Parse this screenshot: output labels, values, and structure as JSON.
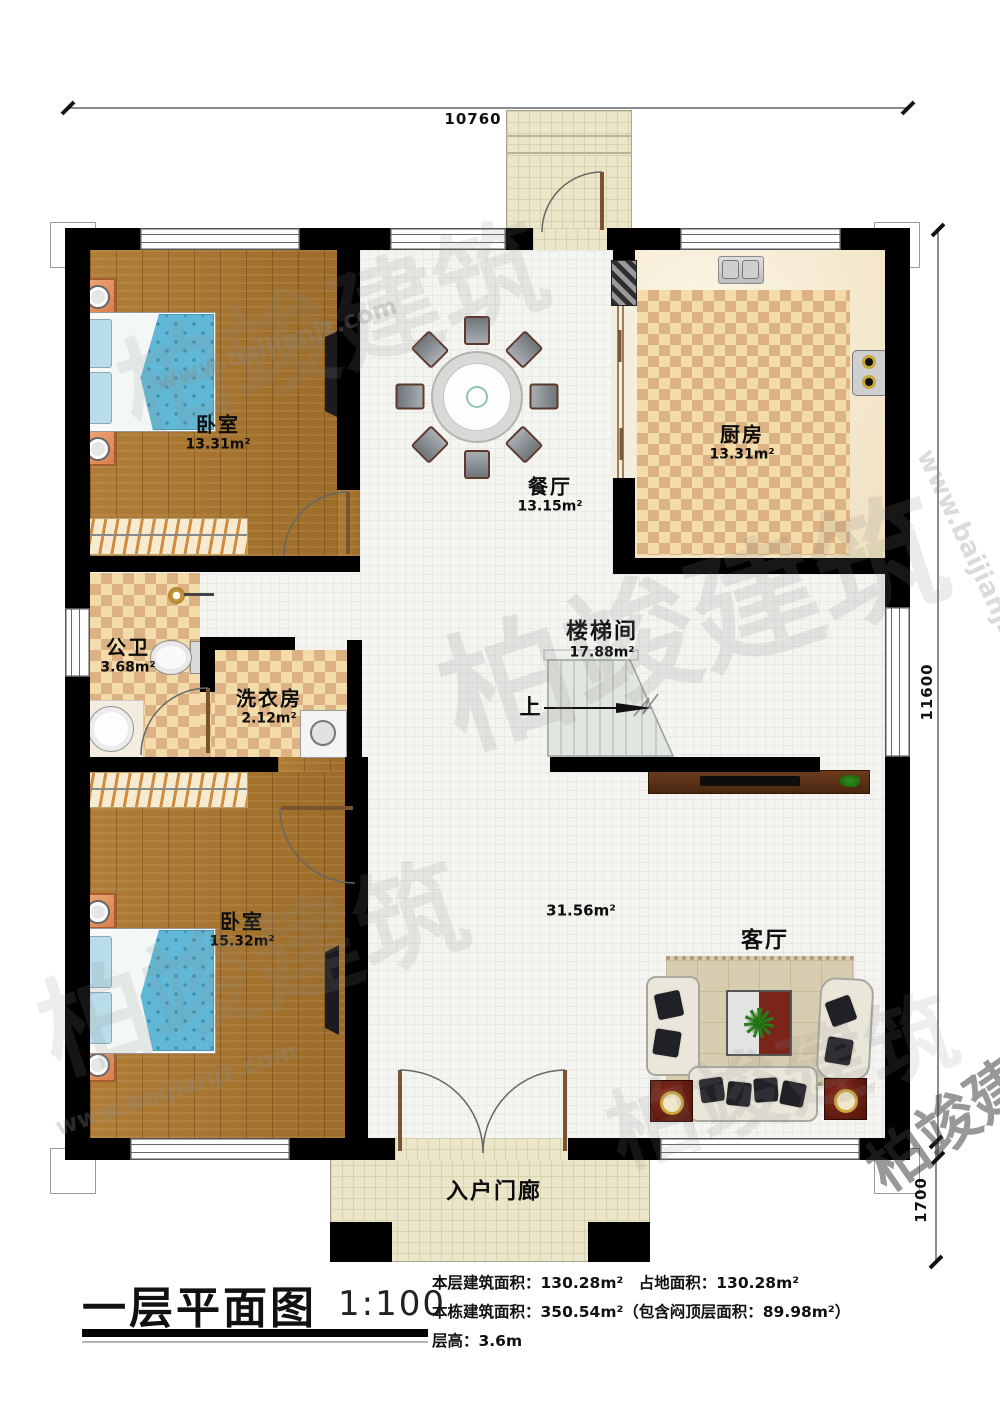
{
  "watermark": {
    "brand": "柏竣建筑",
    "site": "www.baijianjz.com"
  },
  "dimensions": {
    "top": "10760",
    "right": "11600",
    "bottom_right": "1700"
  },
  "stair": {
    "up": "上"
  },
  "rooms": [
    {
      "label": "卧室",
      "area": "13.31m²"
    },
    {
      "label": "餐厅",
      "area": "13.15m²"
    },
    {
      "label": "厨房",
      "area": "13.31m²"
    },
    {
      "label": "公卫",
      "area": "3.68m²"
    },
    {
      "label": "洗衣房",
      "area": "2.12m²"
    },
    {
      "label": "楼梯间",
      "area": "17.88m²"
    },
    {
      "label": "卧室",
      "area": "15.32m²"
    },
    {
      "label": "客厅",
      "area": "31.56m²"
    },
    {
      "label": "入户门廊",
      "area": ""
    }
  ],
  "title_block": {
    "title": "一层平面图",
    "scale": "1:100",
    "stats_line1": "本层建筑面积：130.28m²　占地面积：130.28m²",
    "stats_line2": "本栋建筑面积：350.54m²（包含闷顶层面积：89.98m²）",
    "stats_line3": "层高：3.6m"
  }
}
